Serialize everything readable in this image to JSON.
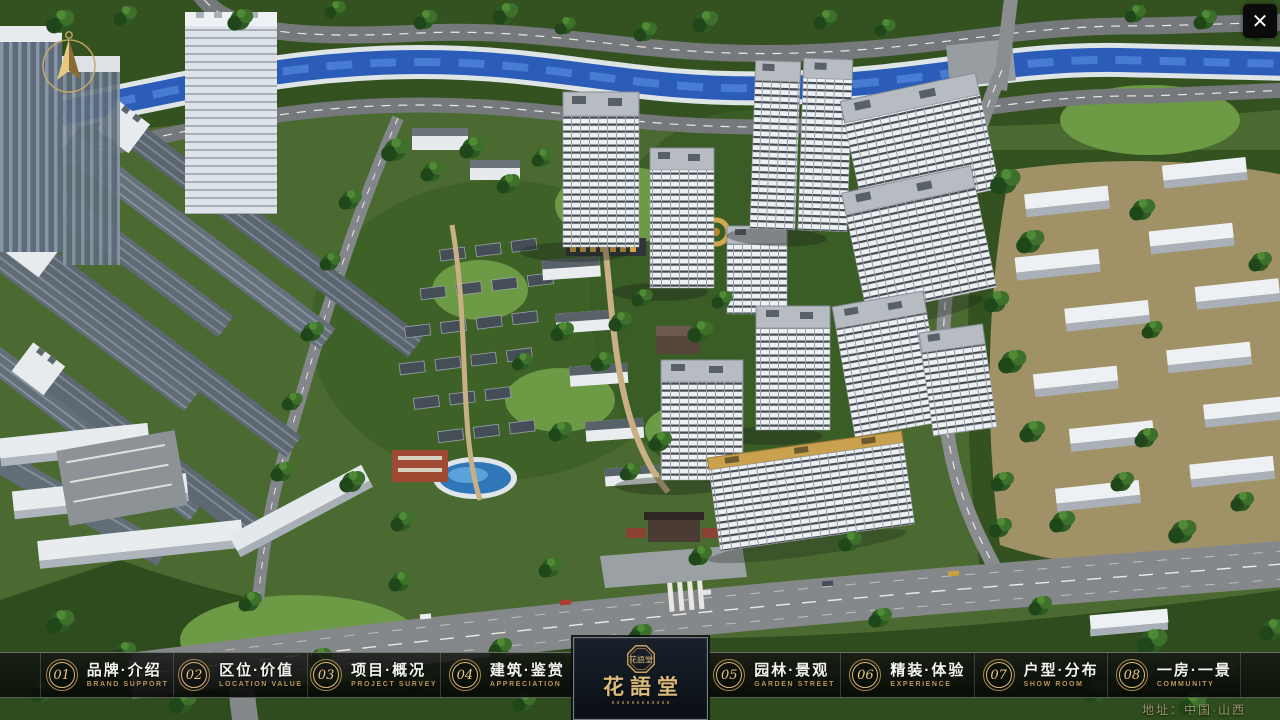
{
  "app": {
    "close_glyph": "✕"
  },
  "theme": {
    "gold": "#c9a15e",
    "gold_bright": "#e6c883",
    "bar_background": "rgba(10,12,10,0.8)",
    "title_white": "#f4f4ee",
    "logo_background": "#10161e"
  },
  "navbar": {
    "items": [
      {
        "number": "01",
        "title": "品牌·介绍",
        "subtitle": "BRAND SUPPORT"
      },
      {
        "number": "02",
        "title": "区位·价值",
        "subtitle": "LOCATION VALUE"
      },
      {
        "number": "03",
        "title": "项目·概况",
        "subtitle": "PROJECT SURVEY"
      },
      {
        "number": "04",
        "title": "建筑·鉴赏",
        "subtitle": "APPRECIATION"
      },
      {
        "number": "05",
        "title": "园林·景观",
        "subtitle": "GARDEN STREET"
      },
      {
        "number": "06",
        "title": "精装·体验",
        "subtitle": "EXPERIENCE"
      },
      {
        "number": "07",
        "title": "户型·分布",
        "subtitle": "SHOW ROOM"
      },
      {
        "number": "08",
        "title": "一房·一景",
        "subtitle": "COMMUNITY"
      }
    ]
  },
  "logo": {
    "title": "花語堂",
    "emblem_text": "花語堂"
  },
  "footer": {
    "address": "地址：中国·山西"
  }
}
